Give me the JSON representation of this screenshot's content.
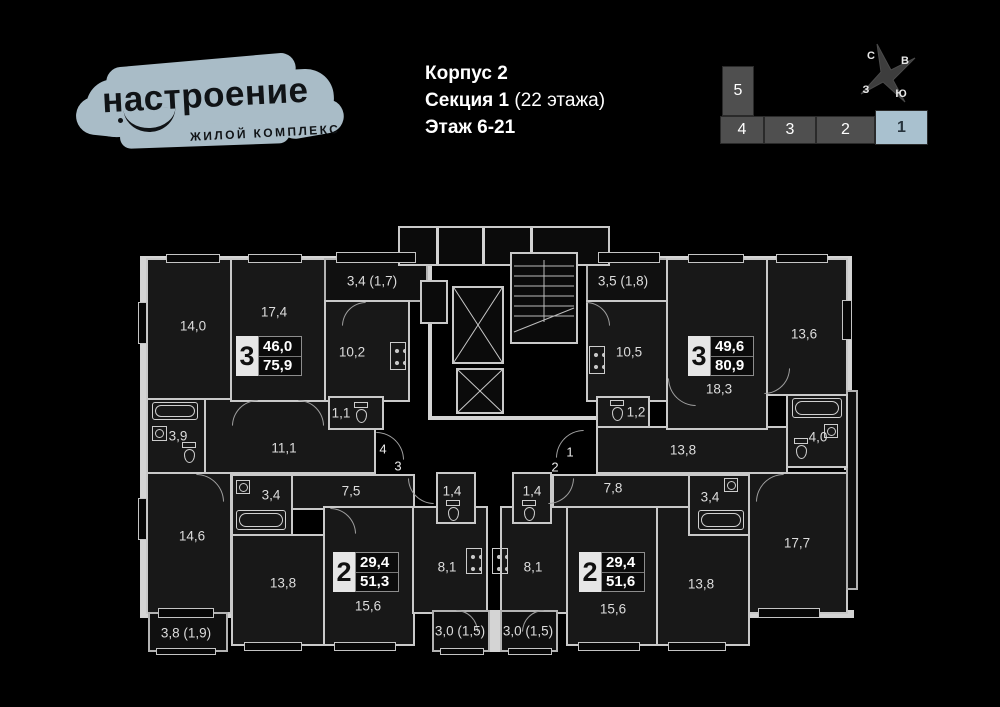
{
  "header": {
    "logo": {
      "title": "настроение",
      "subtitle": "жилой комплекс"
    },
    "info": {
      "line1": "Корпус 2",
      "line2_bold": "Секция 1",
      "line2_normal": "(22 этажа)",
      "line3": "Этаж 6-21"
    },
    "compass": {
      "north": "С",
      "east": "В",
      "west": "З",
      "south": "Ю"
    },
    "sections": {
      "items": [
        {
          "label": "5"
        },
        {
          "label": "4"
        },
        {
          "label": "3"
        },
        {
          "label": "2"
        },
        {
          "label": "1"
        }
      ]
    }
  },
  "plan": {
    "units": [
      {
        "rooms_count": "3",
        "living_area": "46,0",
        "total_area": "75,9"
      },
      {
        "rooms_count": "3",
        "living_area": "49,6",
        "total_area": "80,9"
      },
      {
        "rooms_count": "2",
        "living_area": "29,4",
        "total_area": "51,3"
      },
      {
        "rooms_count": "2",
        "living_area": "29,4",
        "total_area": "51,6"
      }
    ],
    "room_labels": [
      {
        "text": "14,0"
      },
      {
        "text": "17,4"
      },
      {
        "text": "3,4 (1,7)"
      },
      {
        "text": "10,2"
      },
      {
        "text": "3,9"
      },
      {
        "text": "1,1"
      },
      {
        "text": "11,1"
      },
      {
        "text": "14,6"
      },
      {
        "text": "3,8 (1,9)"
      },
      {
        "text": "3,5 (1,8)"
      },
      {
        "text": "10,5"
      },
      {
        "text": "1,2"
      },
      {
        "text": "18,3"
      },
      {
        "text": "13,8"
      },
      {
        "text": "13,6"
      },
      {
        "text": "4,0"
      },
      {
        "text": "17,7"
      },
      {
        "text": "3,4"
      },
      {
        "text": "7,5"
      },
      {
        "text": "13,8"
      },
      {
        "text": "15,6"
      },
      {
        "text": "1,4"
      },
      {
        "text": "8,1"
      },
      {
        "text": "3,0 (1,5)"
      },
      {
        "text": "1,4"
      },
      {
        "text": "8,1"
      },
      {
        "text": "3,0 (1,5)"
      },
      {
        "text": "7,8"
      },
      {
        "text": "3,4"
      },
      {
        "text": "15,6"
      },
      {
        "text": "13,8"
      }
    ],
    "entrance_numbers": [
      {
        "text": "4"
      },
      {
        "text": "3"
      },
      {
        "text": "1"
      },
      {
        "text": "2"
      }
    ]
  },
  "colors": {
    "section_active": "#a9c1cf",
    "section_gray": "#4f4f4f",
    "wall": "#d4d4d4",
    "logo_brush": "#a9bcc7"
  }
}
